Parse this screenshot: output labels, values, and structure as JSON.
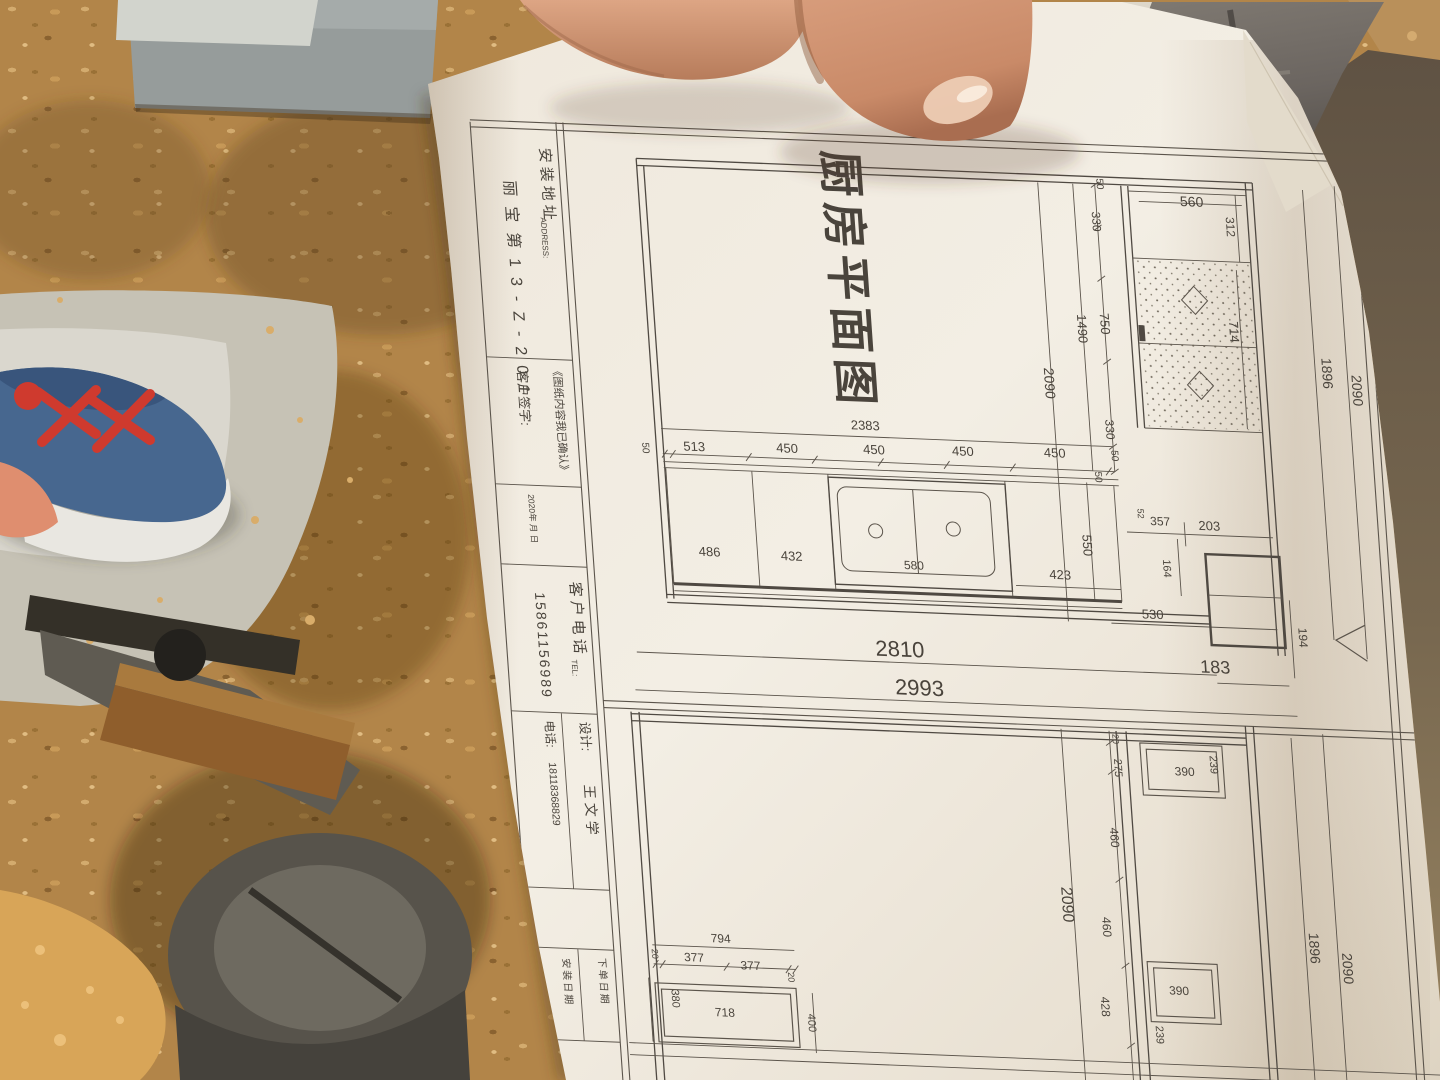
{
  "drawing": {
    "header": [
      {
        "t": "厨房平面图",
        "x": 822,
        "y": 129,
        "r": 90,
        "fs": 46,
        "ls": 6,
        "w": 600,
        "a": "start"
      }
    ],
    "title_block": [
      {
        "t": "安装地址",
        "x": 538,
        "y": 138,
        "r": 90,
        "fs": 15,
        "ls": 4,
        "a": "start"
      },
      {
        "t": "ADDRESS:",
        "x": 534,
        "y": 208,
        "r": 90,
        "fs": 8,
        "a": "start"
      },
      {
        "t": "丽宝第13-Z-201",
        "x": 500,
        "y": 172,
        "r": 90,
        "fs": 16,
        "ls": 10,
        "a": "start"
      },
      {
        "t": "《图纸内容我已确认》",
        "x": 536,
        "y": 356,
        "r": 90,
        "fs": 11,
        "a": "start"
      },
      {
        "t": "客户签字:",
        "x": 500,
        "y": 362,
        "r": 90,
        "fs": 13,
        "a": "start"
      },
      {
        "t": "2020年 月 日",
        "x": 502,
        "y": 486,
        "r": 90,
        "fs": 8.5,
        "a": "start"
      },
      {
        "t": "客户电话",
        "x": 538,
        "y": 572,
        "r": 90,
        "fs": 15,
        "ls": 4,
        "a": "start"
      },
      {
        "t": "TEL:",
        "x": 534,
        "y": 650,
        "r": 90,
        "fs": 8,
        "a": "start"
      },
      {
        "t": "15861156989",
        "x": 502,
        "y": 584,
        "r": 90,
        "fs": 14,
        "ls": 2,
        "a": "start"
      },
      {
        "t": "设计:",
        "x": 538,
        "y": 712,
        "r": 90,
        "fs": 13,
        "a": "start"
      },
      {
        "t": "王文学",
        "x": 538,
        "y": 775,
        "r": 90,
        "fs": 14,
        "ls": 4,
        "a": "start"
      },
      {
        "t": "电话:",
        "x": 503,
        "y": 712,
        "r": 90,
        "fs": 12,
        "a": "start"
      },
      {
        "t": "18118368829",
        "x": 504,
        "y": 754,
        "r": 90,
        "fs": 10.5,
        "a": "start"
      },
      {
        "t": "下单日期",
        "x": 540,
        "y": 948,
        "r": 90,
        "fs": 10,
        "ls": 2,
        "a": "start"
      },
      {
        "t": "安装日期",
        "x": 504,
        "y": 950,
        "r": 90,
        "fs": 10,
        "ls": 2,
        "a": "start"
      }
    ],
    "plan": [
      {
        "t": "560",
        "x": 1188,
        "y": 171,
        "r": 0,
        "fs": 14
      },
      {
        "t": "312",
        "x": 1221,
        "y": 190,
        "r": 90,
        "fs": 12
      },
      {
        "t": "714",
        "x": 1217,
        "y": 295,
        "r": 90,
        "fs": 13
      },
      {
        "t": "50",
        "x": 1094,
        "y": 152,
        "r": 90,
        "fs": 10
      },
      {
        "t": "330",
        "x": 1087,
        "y": 190,
        "r": 90,
        "fs": 12
      },
      {
        "t": "750",
        "x": 1088,
        "y": 292,
        "r": 90,
        "fs": 13
      },
      {
        "t": "1490",
        "x": 1065,
        "y": 298,
        "r": 90,
        "fs": 13
      },
      {
        "t": "2090",
        "x": 1028,
        "y": 354,
        "r": 90,
        "fs": 14
      },
      {
        "t": "330",
        "x": 1086,
        "y": 398,
        "r": 90,
        "fs": 12
      },
      {
        "t": "50",
        "x": 1090,
        "y": 424,
        "r": 90,
        "fs": 10
      },
      {
        "t": "50",
        "x": 1072,
        "y": 446,
        "r": 90,
        "fs": 10
      },
      {
        "t": "1896",
        "x": 1307,
        "y": 333,
        "r": 90,
        "fs": 14
      },
      {
        "t": "2090",
        "x": 1336,
        "y": 349,
        "r": 90,
        "fs": 14
      },
      {
        "t": "2383",
        "x": 845,
        "y": 408,
        "r": 0,
        "fs": 13
      },
      {
        "t": "50",
        "x": 620,
        "y": 435,
        "r": 90,
        "fs": 10
      },
      {
        "t": "513",
        "x": 672,
        "y": 436,
        "r": 0,
        "fs": 13
      },
      {
        "t": "450",
        "x": 765,
        "y": 434,
        "r": 0,
        "fs": 13
      },
      {
        "t": "450",
        "x": 852,
        "y": 432,
        "r": 0,
        "fs": 13
      },
      {
        "t": "450",
        "x": 941,
        "y": 430,
        "r": 0,
        "fs": 13
      },
      {
        "t": "450",
        "x": 1033,
        "y": 428,
        "r": 0,
        "fs": 13
      },
      {
        "t": "486",
        "x": 680,
        "y": 541,
        "r": 0,
        "fs": 13
      },
      {
        "t": "432",
        "x": 762,
        "y": 542,
        "r": 0,
        "fs": 13
      },
      {
        "t": "580",
        "x": 884,
        "y": 546,
        "r": 0,
        "fs": 12
      },
      {
        "t": "423",
        "x": 1030,
        "y": 550,
        "r": 0,
        "fs": 13
      },
      {
        "t": "550",
        "x": 1055,
        "y": 515,
        "r": 90,
        "fs": 13
      },
      {
        "t": "52",
        "x": 1112,
        "y": 481,
        "r": 90,
        "fs": 9
      },
      {
        "t": "357",
        "x": 1134,
        "y": 492,
        "r": 0,
        "fs": 12
      },
      {
        "t": "203",
        "x": 1183,
        "y": 495,
        "r": 0,
        "fs": 13
      },
      {
        "t": "164",
        "x": 1134,
        "y": 535,
        "r": 90,
        "fs": 11
      },
      {
        "t": "530",
        "x": 1120,
        "y": 586,
        "r": 0,
        "fs": 13
      },
      {
        "t": "194",
        "x": 1265,
        "y": 599,
        "r": 90,
        "fs": 12
      },
      {
        "t": "2810",
        "x": 864,
        "y": 634,
        "r": 0,
        "fs": 22
      },
      {
        "t": "183",
        "x": 1179,
        "y": 638,
        "r": 0,
        "fs": 18
      },
      {
        "t": "2993",
        "x": 881,
        "y": 672,
        "r": 0,
        "fs": 22
      }
    ],
    "lower": [
      {
        "t": "20",
        "x": 1071,
        "y": 708,
        "r": 90,
        "fs": 9
      },
      {
        "t": "275",
        "x": 1071,
        "y": 737,
        "r": 90,
        "fs": 11
      },
      {
        "t": "390",
        "x": 1141,
        "y": 742,
        "r": 0,
        "fs": 12
      },
      {
        "t": "239",
        "x": 1167,
        "y": 730,
        "r": 90,
        "fs": 11
      },
      {
        "t": "460",
        "x": 1062,
        "y": 807,
        "r": 90,
        "fs": 12
      },
      {
        "t": "2090",
        "x": 1009,
        "y": 876,
        "r": 90,
        "fs": 16
      },
      {
        "t": "460",
        "x": 1048,
        "y": 897,
        "r": 90,
        "fs": 12
      },
      {
        "t": "428",
        "x": 1041,
        "y": 977,
        "r": 90,
        "fs": 12
      },
      {
        "t": "390",
        "x": 1120,
        "y": 962,
        "r": 0,
        "fs": 12
      },
      {
        "t": "239",
        "x": 1094,
        "y": 1003,
        "r": 90,
        "fs": 11
      },
      {
        "t": "1896",
        "x": 1254,
        "y": 910,
        "r": 90,
        "fs": 14
      },
      {
        "t": "2090",
        "x": 1286,
        "y": 929,
        "r": 90,
        "fs": 14
      },
      {
        "t": "794",
        "x": 664,
        "y": 928,
        "r": 0,
        "fs": 12
      },
      {
        "t": "20",
        "x": 594,
        "y": 942,
        "r": 90,
        "fs": 9
      },
      {
        "t": "377",
        "x": 636,
        "y": 948,
        "r": 0,
        "fs": 12
      },
      {
        "t": "377",
        "x": 692,
        "y": 954,
        "r": 0,
        "fs": 12
      },
      {
        "t": "20",
        "x": 729,
        "y": 960,
        "r": 90,
        "fs": 9
      },
      {
        "t": "380",
        "x": 611,
        "y": 986,
        "r": 90,
        "fs": 11
      },
      {
        "t": "718",
        "x": 663,
        "y": 1002,
        "r": 0,
        "fs": 12
      },
      {
        "t": "400",
        "x": 746,
        "y": 1005,
        "r": 90,
        "fs": 11
      }
    ]
  }
}
